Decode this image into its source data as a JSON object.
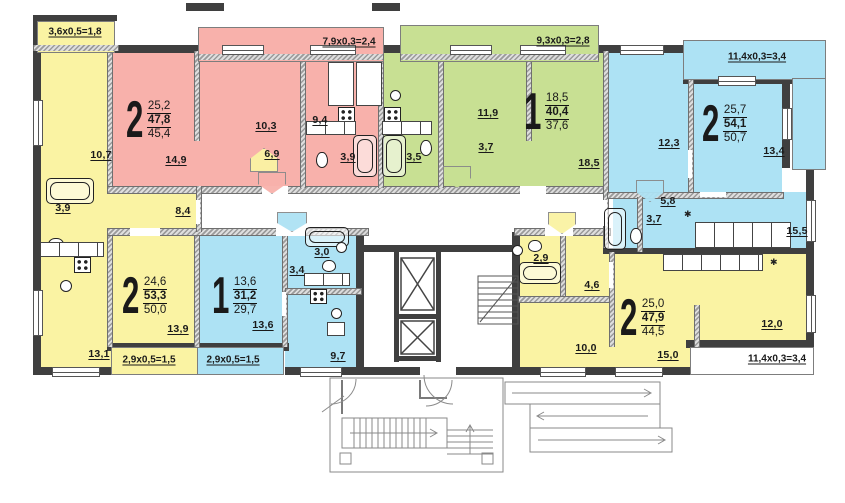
{
  "plan": {
    "title": "apartment-floor-plan",
    "apartments": [
      {
        "name": "two-room-pink",
        "rooms": "2",
        "living": "25,2",
        "total": "47,8",
        "reduced": "45,4"
      },
      {
        "name": "one-room-green",
        "rooms": "1",
        "living": "18,5",
        "total": "40,4",
        "reduced": "37,6"
      },
      {
        "name": "two-room-blue-top",
        "rooms": "2",
        "living": "25,7",
        "total": "54,1",
        "reduced": "50,7"
      },
      {
        "name": "two-room-yellow-left",
        "rooms": "2",
        "living": "24,6",
        "total": "53,3",
        "reduced": "50,0"
      },
      {
        "name": "one-room-blue-bottom",
        "rooms": "1",
        "living": "13,6",
        "total": "31,2",
        "reduced": "29,7"
      },
      {
        "name": "two-room-yellow-right",
        "rooms": "2",
        "living": "25,0",
        "total": "47,9",
        "reduced": "44,5"
      }
    ],
    "room_labels": [
      "10,7",
      "3,9",
      "13,1",
      "8,4",
      "13,9",
      "14,9",
      "10,3",
      "6,9",
      "9,4",
      "3,9",
      "3,5",
      "3,7",
      "11,9",
      "18,5",
      "12,3",
      "13,4",
      "5,8",
      "3,7",
      "15,5",
      "13,6",
      "3,0",
      "3,4",
      "9,7",
      "2,9",
      "4,6",
      "10,0",
      "15,0",
      "12,0"
    ],
    "balcony_labels": [
      "3,6x0,5=1,8",
      "7,9x0,3=2,4",
      "9,3x0,3=2,8",
      "11,4x0,3=3,4",
      "2,9x0,5=1,5",
      "2,9x0,5=1,5",
      "11,4x0,3=3,4"
    ],
    "colors": {
      "yellow": "#FAF3A3",
      "pink": "#F8B1AB",
      "green": "#C8E093",
      "blue": "#ADE2F4",
      "wall": "#3F3F3F"
    }
  }
}
